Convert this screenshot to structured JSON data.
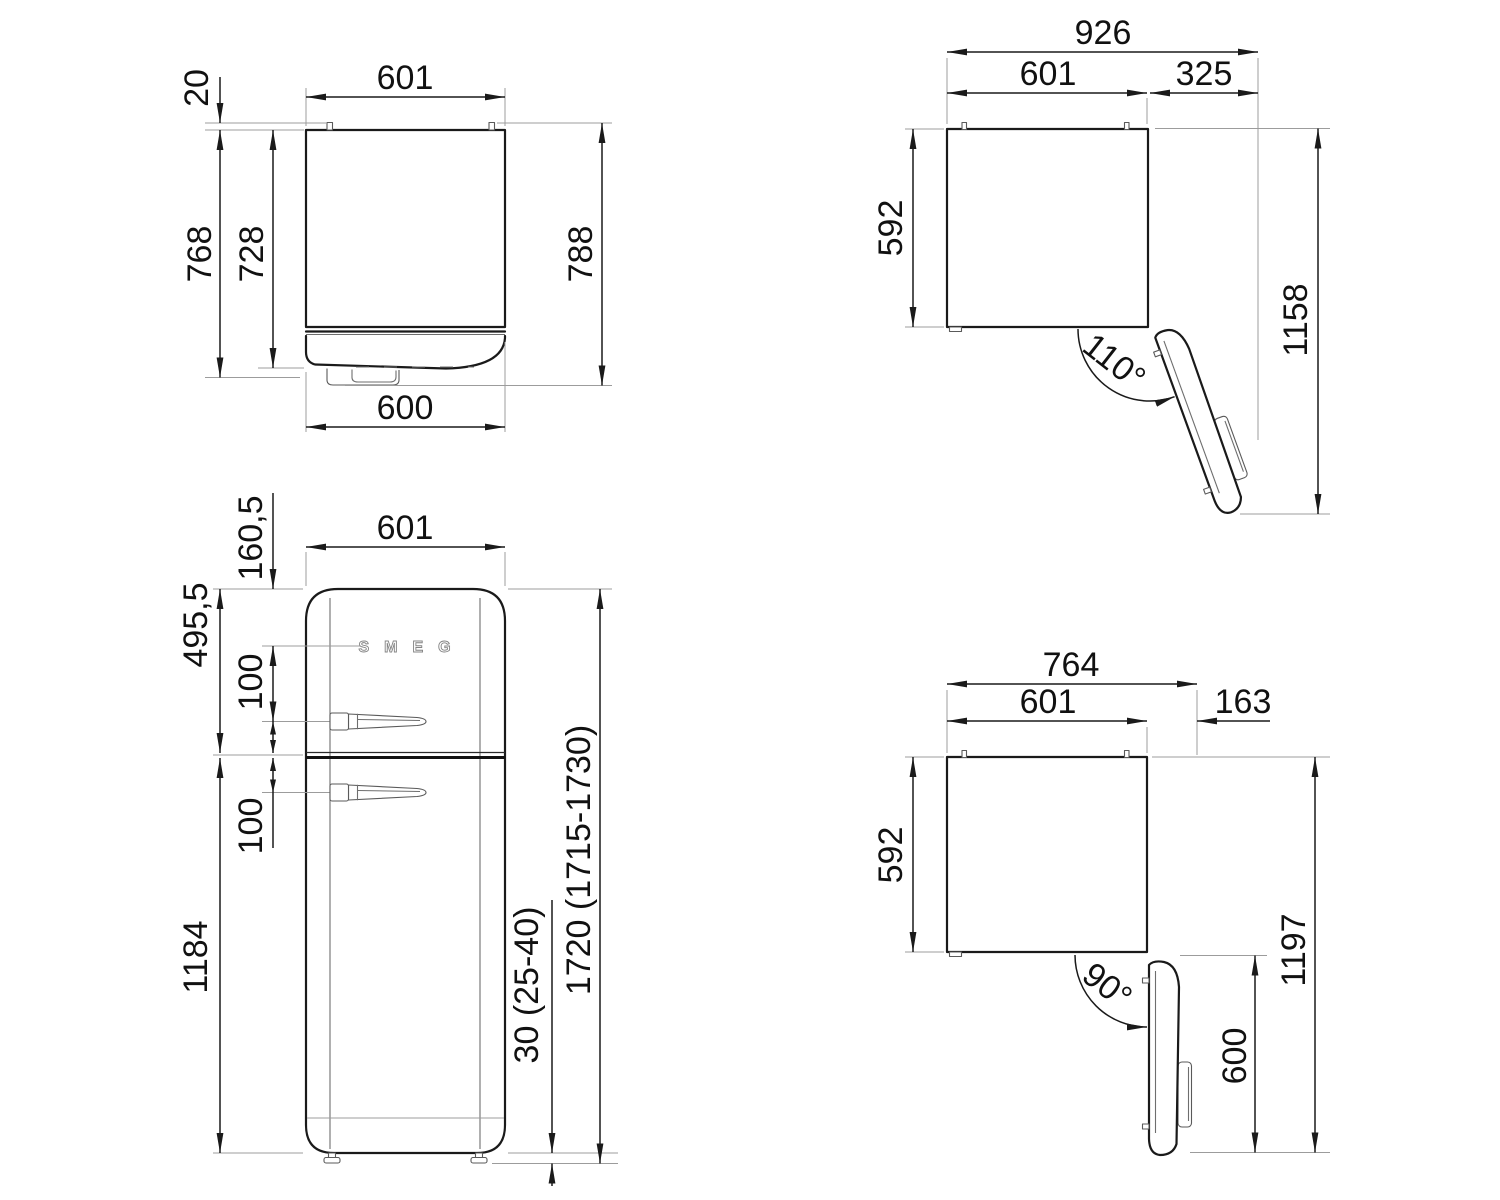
{
  "drawing": {
    "side": {
      "top_width": "601",
      "pin_gap": "20",
      "depth_body": "728",
      "depth_door": "768",
      "depth_total": "788",
      "bottom_width": "600"
    },
    "top110": {
      "total_width": "926",
      "body_width": "601",
      "door_extension": "325",
      "body_depth": "592",
      "total_depth": "1158",
      "angle": "110°"
    },
    "front": {
      "logo": "SMEG",
      "width": "601",
      "logo_from_top": "160,5",
      "upper_section": "495,5",
      "upper_handle_gap": "100",
      "lower_handle_gap": "100",
      "lower_door_height": "1184",
      "total_height": "1720 (1715-1730)",
      "feet_height": "30 (25-40)"
    },
    "top90": {
      "total_width": "764",
      "body_width": "601",
      "door_extension": "163",
      "body_depth": "592",
      "total_depth": "1197",
      "door_depth": "600",
      "angle": "90°"
    }
  }
}
